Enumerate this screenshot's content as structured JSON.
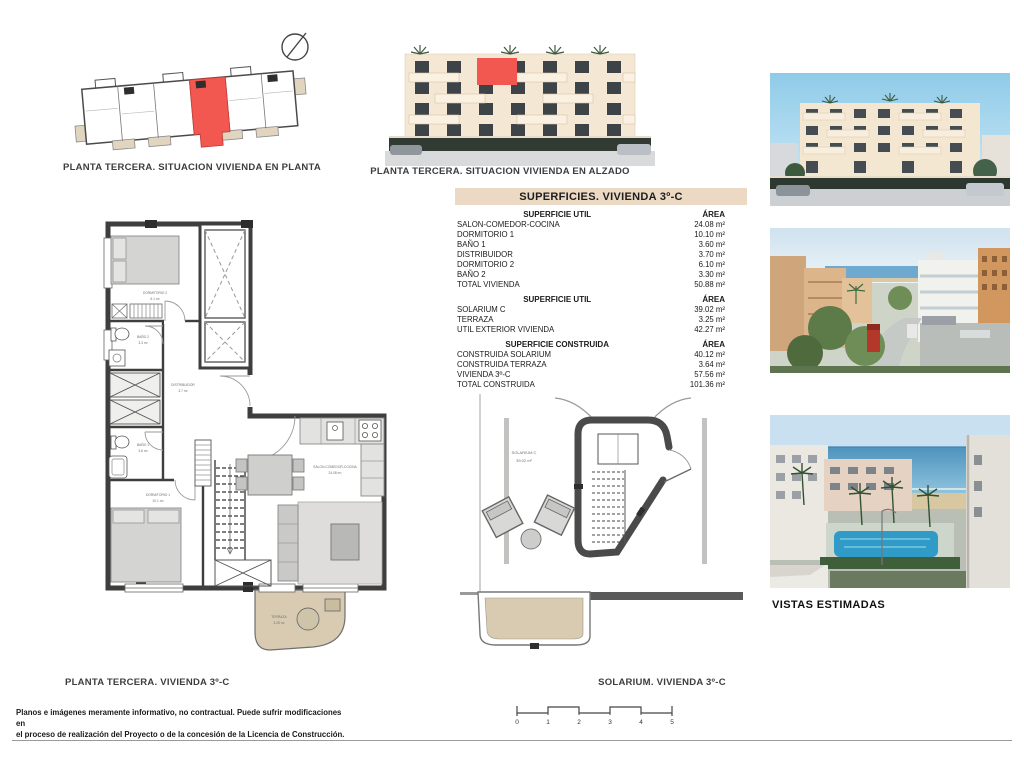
{
  "sheet": {
    "captions": {
      "key_plan": "PLANTA TERCERA. SITUACION VIVIENDA EN PLANTA",
      "elevation": "PLANTA TERCERA. SITUACION VIVIENDA EN ALZADO",
      "floor_plan": "PLANTA  TERCERA. VIVIENDA 3º-C",
      "solarium": "SOLARIUM. VIVIENDA 3º-C",
      "views": "VISTAS ESTIMADAS"
    },
    "disclaimer_line1": "Planos e imágenes meramente informativo, no contractual. Puede sufrir modificaciones en",
    "disclaimer_line2": "el proceso de realización del Proyecto o de la concesión de la Licencia de Construcción."
  },
  "surfaces_table": {
    "title": "SUPERFICIES. VIVIENDA 3º-C",
    "sections": [
      {
        "header": "SUPERFICIE UTIL",
        "area_header": "ÁREA",
        "rows": [
          {
            "label": "SALON-COMEDOR-COCINA",
            "value": "24.08 m²"
          },
          {
            "label": "DORMITORIO 1",
            "value": "10.10 m²"
          },
          {
            "label": "BAÑO 1",
            "value": "3.60 m²"
          },
          {
            "label": "DISTRIBUIDOR",
            "value": "3.70 m²"
          },
          {
            "label": "DORMITORIO 2",
            "value": "6.10 m²"
          },
          {
            "label": "BAÑO 2",
            "value": "3.30 m²"
          },
          {
            "label": "TOTAL VIVIENDA",
            "value": "50.88 m²"
          }
        ]
      },
      {
        "header": "SUPERFICIE UTIL",
        "area_header": "ÁREA",
        "rows": [
          {
            "label": "SOLARIUM C",
            "value": "39.02 m²"
          },
          {
            "label": "TERRAZA",
            "value": "3.25 m²"
          },
          {
            "label": "UTIL EXTERIOR VIVIENDA",
            "value": "42.27 m²"
          }
        ]
      },
      {
        "header": "SUPERFICIE CONSTRUIDA",
        "area_header": "ÁREA",
        "rows": [
          {
            "label": "CONSTRUIDA SOLARIUM",
            "value": "40.12 m²"
          },
          {
            "label": "CONSTRUIDA TERRAZA",
            "value": "3.64 m²"
          },
          {
            "label": "VIVIENDA 3º-C",
            "value": "57.56 m²"
          },
          {
            "label": "TOTAL CONSTRUIDA",
            "value": "101.36 m²"
          }
        ]
      }
    ]
  },
  "floor_plan": {
    "rooms": {
      "dormitorio2": {
        "name": "DORMITORIO 2",
        "area": "6.1 m²"
      },
      "bano2": {
        "name": "BAÑO 2",
        "area": "3.3 m²"
      },
      "distribuidor": {
        "name": "DISTRIBUIDOR",
        "area": "3.7 m²"
      },
      "bano1": {
        "name": "BAÑO 1",
        "area": "3.6 m²"
      },
      "dormitorio1": {
        "name": "DORMITORIO 1",
        "area": "10.1 m²"
      },
      "salon": {
        "name": "SALON-COMEDOR-COCINA",
        "area": "24.08 m²"
      },
      "terraza": {
        "name": "TERRAZA",
        "area": "3.25 m²"
      }
    }
  },
  "solarium_plan": {
    "room": {
      "name": "SOLARIUM C",
      "area": "39.02 m²"
    }
  },
  "scale_bar": {
    "ticks": [
      "0",
      "1",
      "2",
      "3",
      "4",
      "5"
    ]
  },
  "colors": {
    "highlight_red": "#f25750",
    "table_header_bg": "#ecd9c4",
    "terrace_beige": "#d9cbb2",
    "wall_dark": "#3e3e3e"
  }
}
